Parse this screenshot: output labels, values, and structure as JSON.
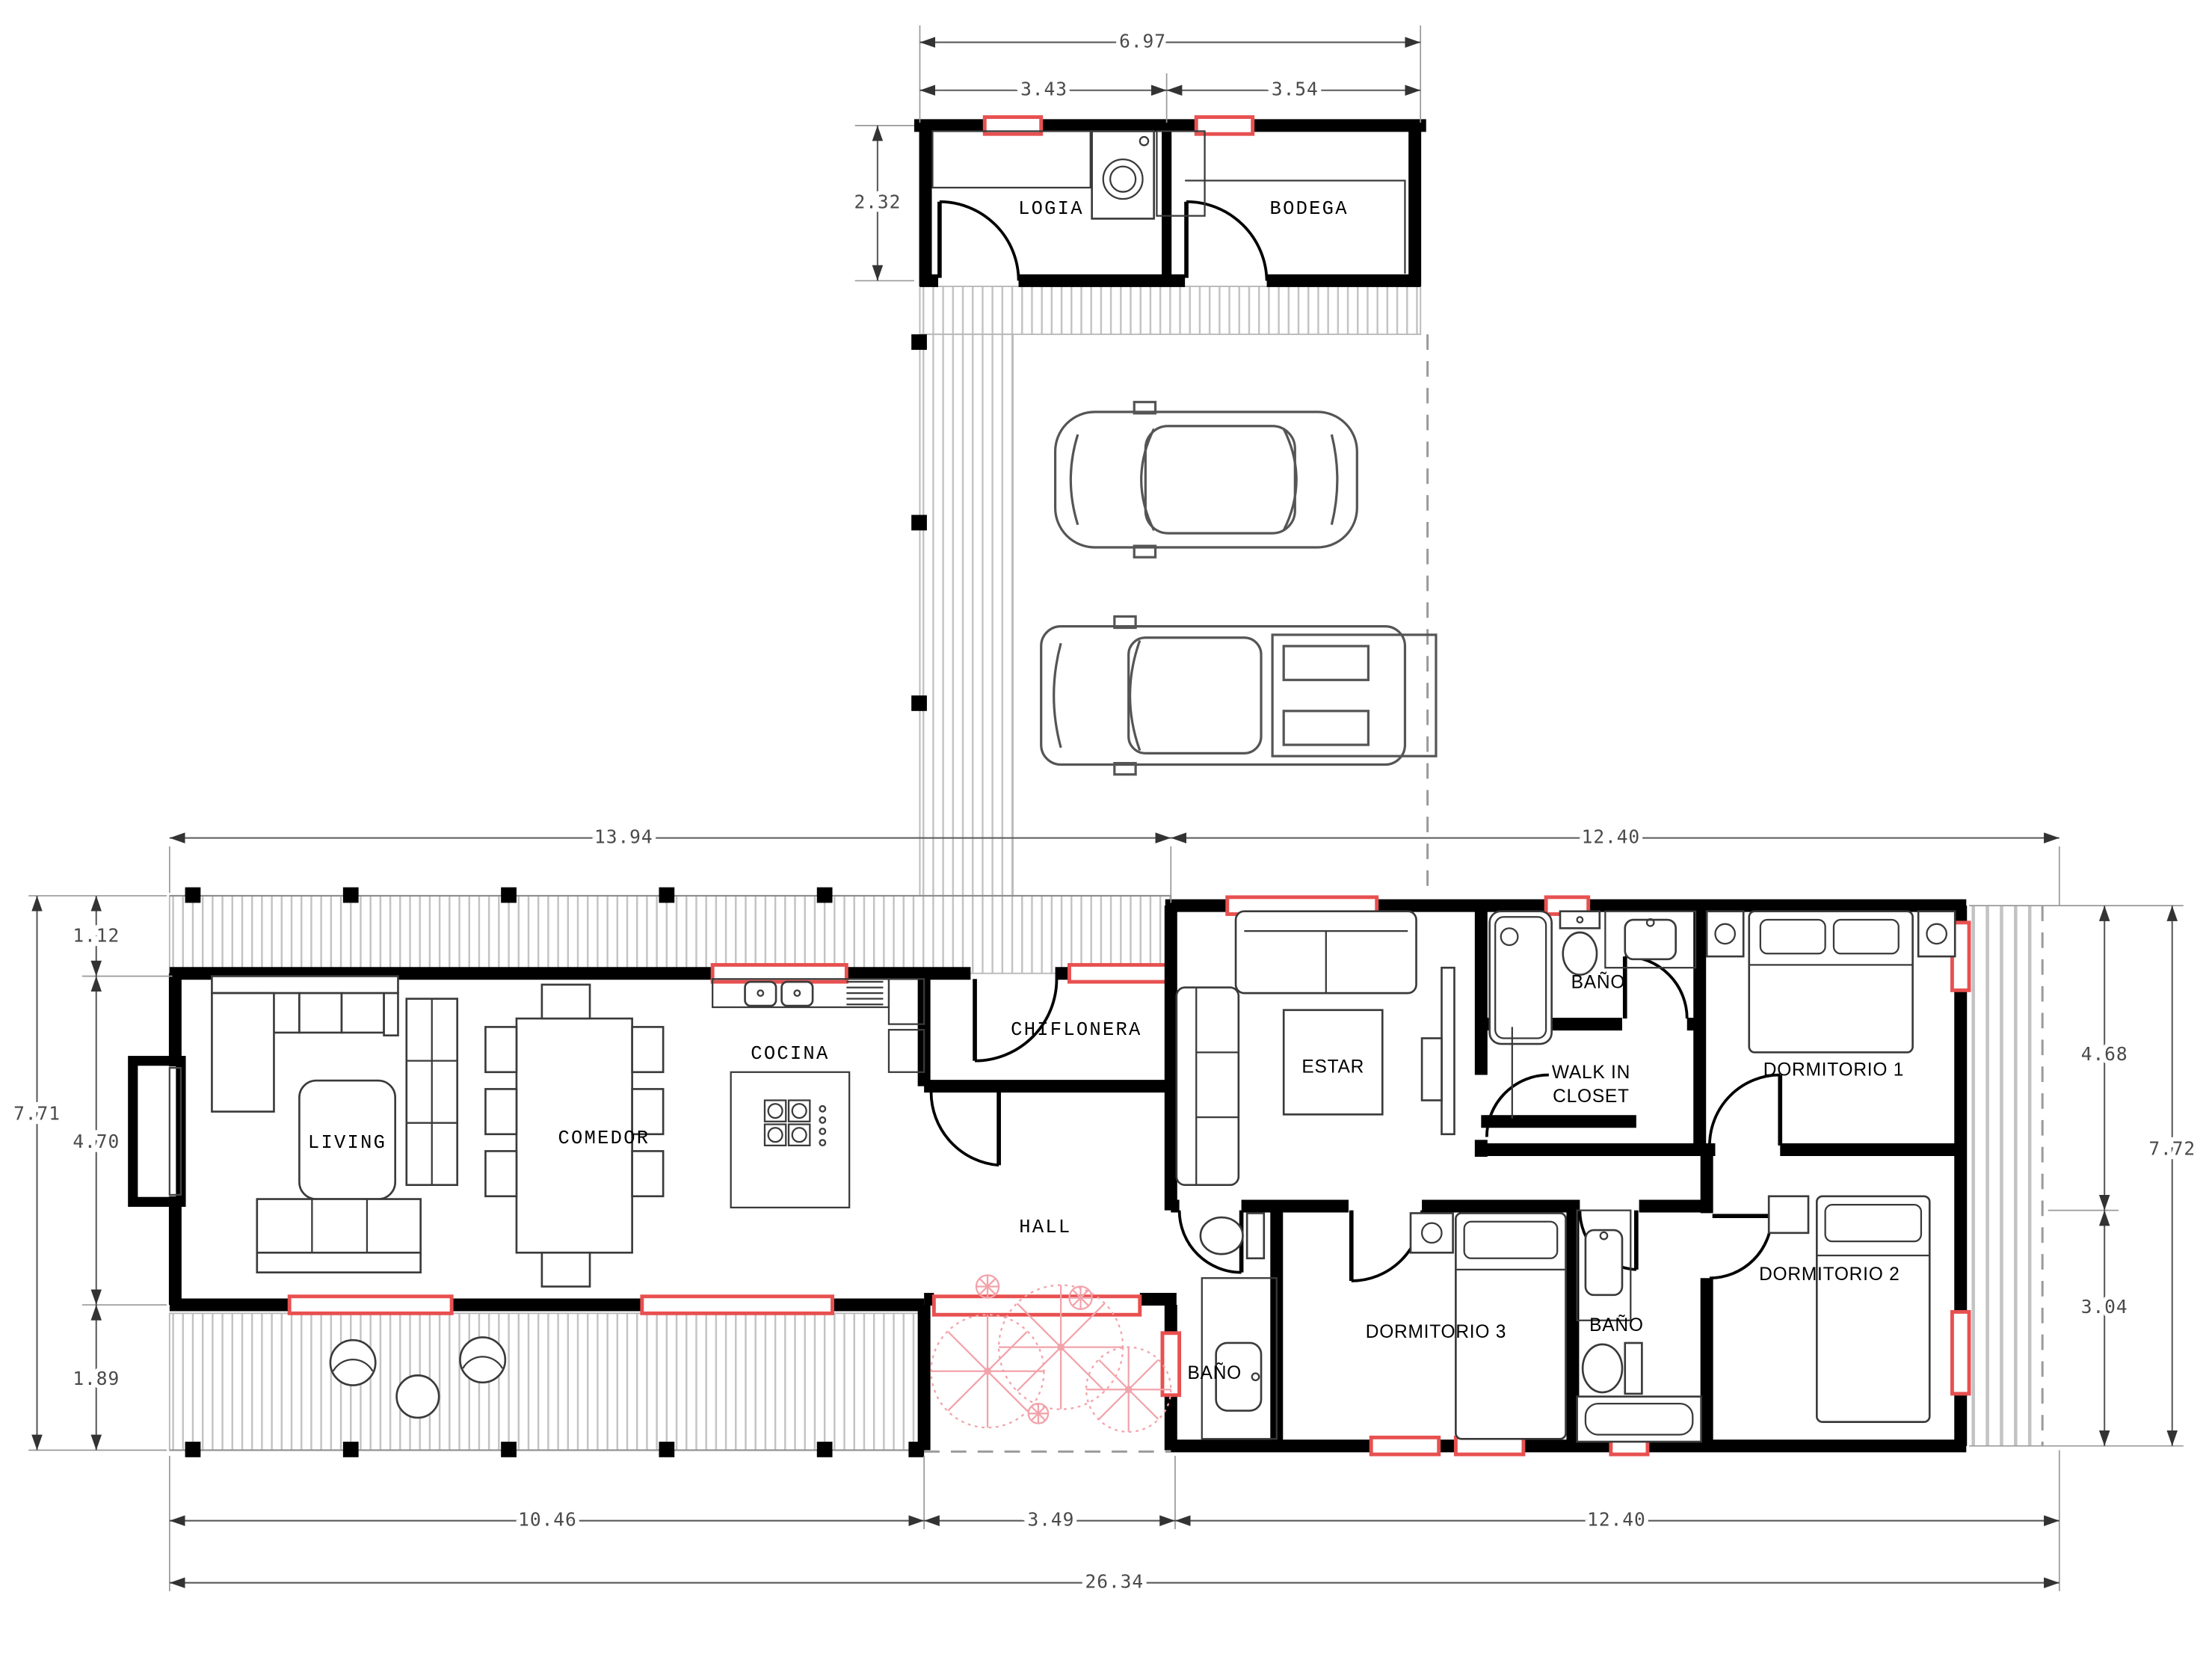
{
  "plan": {
    "rooms": {
      "logia": "LOGIA",
      "bodega": "BODEGA",
      "living": "LIVING",
      "comedor": "COMEDOR",
      "cocina": "COCINA",
      "chiflonera": "CHIFLONERA",
      "hall": "HALL",
      "estar": "ESTAR",
      "bano_top": "BAÑO",
      "walk_in_line1": "WALK IN",
      "walk_in_line2": "CLOSET",
      "dormitorio1": "DORMITORIO 1",
      "dormitorio2": "DORMITORIO 2",
      "dormitorio3": "DORMITORIO 3",
      "bano_mid": "BAÑO",
      "bano_small": "BAÑO"
    },
    "dims": {
      "annex_total_w": "6.97",
      "annex_left_w": "3.43",
      "annex_right_w": "3.54",
      "annex_h": "2.32",
      "left_wing_w": "13.94",
      "right_wing_w_top": "12.40",
      "terrace_top_h": "1.12",
      "living_h": "4.70",
      "left_total_h": "7.71",
      "terrace_bottom_h": "1.89",
      "right_upper_h": "4.68",
      "right_total_h": "7.72",
      "right_lower_h": "3.04",
      "bottom_left_w": "10.46",
      "courtyard_w": "3.49",
      "right_wing_w_bottom": "12.40",
      "total_w": "26.34"
    },
    "colors": {
      "accent_red": "#e85050",
      "flower_pink": "#f2a3aa",
      "hatch_gray": "#c3c3c3",
      "dim_gray": "#5a5a5a",
      "dash_gray": "#9a9a9a",
      "car_gray": "#555555",
      "wall_black": "#000000"
    }
  }
}
